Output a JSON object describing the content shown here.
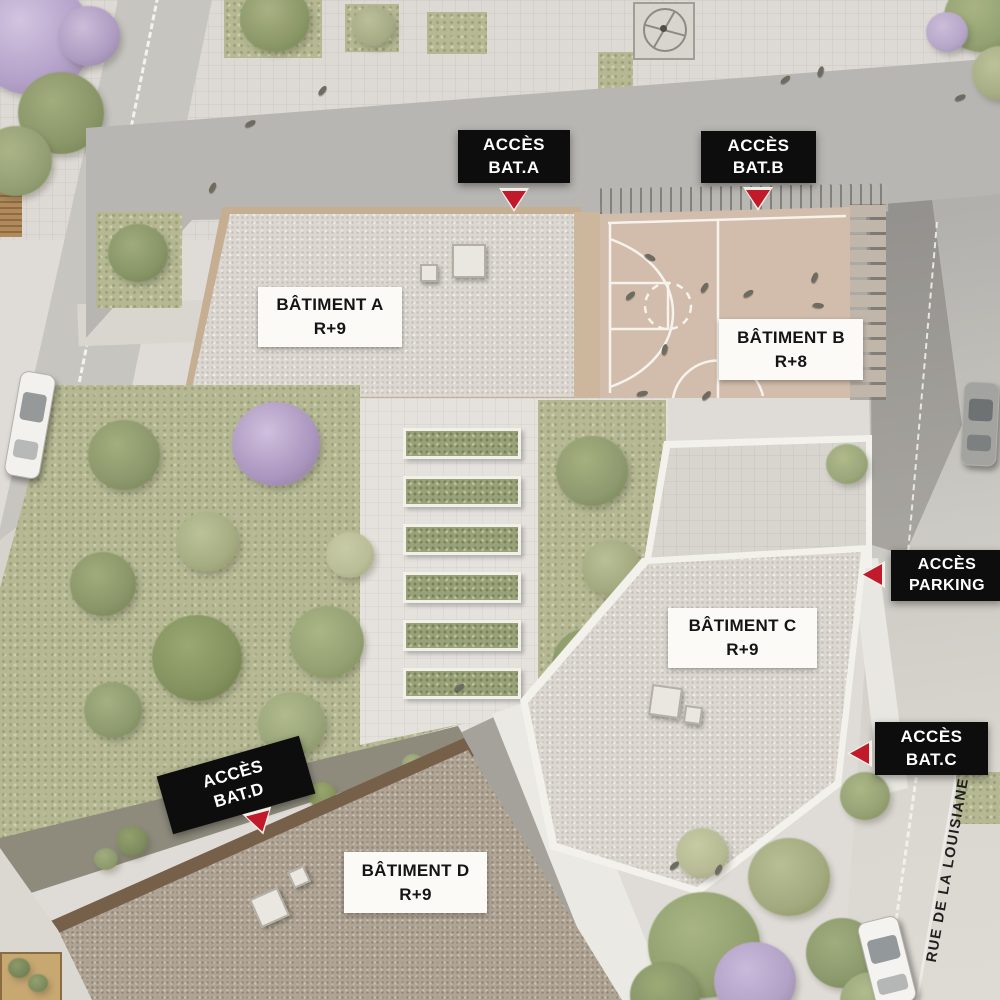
{
  "plan": {
    "street_label": "RUE DE LA LOUISIANE",
    "buildings": [
      {
        "name": "BÂTIMENT A",
        "level": "R+9"
      },
      {
        "name": "BÂTIMENT B",
        "level": "R+8"
      },
      {
        "name": "BÂTIMENT C",
        "level": "R+9"
      },
      {
        "name": "BÂTIMENT D",
        "level": "R+9"
      }
    ],
    "access_markers": [
      {
        "line1": "ACCÈS",
        "line2": "BAT.A"
      },
      {
        "line1": "ACCÈS",
        "line2": "BAT.B"
      },
      {
        "line1": "ACCÈS",
        "line2": "PARKING"
      },
      {
        "line1": "ACCÈS",
        "line2": "BAT.C"
      },
      {
        "line1": "ACCÈS",
        "line2": "BAT.D"
      }
    ],
    "colors": {
      "marker-bg": "#0d0d0d",
      "marker-text": "#ffffff",
      "label-bg": "#fbfaf7",
      "label-text": "#141414",
      "arrow": "#c01a2b"
    }
  }
}
